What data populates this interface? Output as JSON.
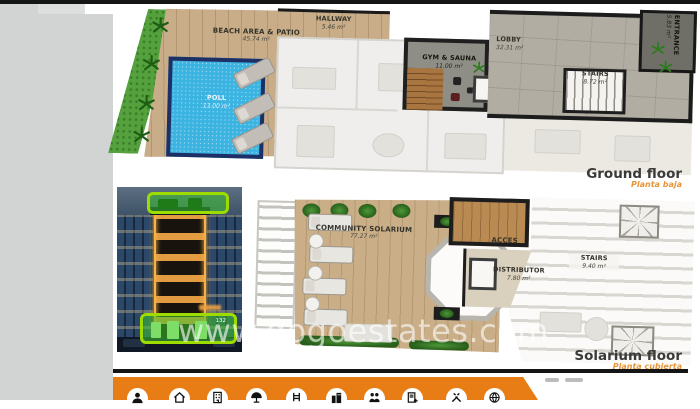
{
  "colors": {
    "accent_orange": "#e87d15",
    "subtitle_orange": "#e6953a",
    "highlight_green": "#9edc00",
    "pool_blue": "#3cb4e2",
    "title_gray": "#3a3a3a",
    "wall_black": "#1c1c1c"
  },
  "watermark": {
    "text": "www.gogoestates.com"
  },
  "photo": {
    "badge": "132"
  },
  "ground_floor": {
    "title": "Ground floor",
    "subtitle": "Planta baja",
    "rooms": {
      "beach": {
        "name": "BEACH AREA & PATIO",
        "area": "45.74 m²"
      },
      "pool": {
        "name": "POLL",
        "area": "13.00 m²"
      },
      "hallway": {
        "name": "HALLWAY",
        "area": "5.46 m²"
      },
      "gym": {
        "name": "GYM & SAUNA",
        "area": "11.00 m²"
      },
      "lobby": {
        "name": "LOBBY",
        "area": "32.31 m²"
      },
      "stairs": {
        "name": "STAIRS",
        "area": "8.72 m²"
      },
      "entrance": {
        "name": "ENTRANCE",
        "area": "5.83 m²"
      }
    }
  },
  "solarium_floor": {
    "title": "Solarium floor",
    "subtitle": "Planta cubierta",
    "rooms": {
      "community": {
        "name": "COMMUNITY SOLARIUM",
        "area": "77.27 m²"
      },
      "acces": {
        "name": "ACCES",
        "area": ""
      },
      "distributor": {
        "name": "DISTRIBUTOR",
        "area": "7.80 m²"
      },
      "stairs": {
        "name": "STAIRS",
        "area": "9.40 m²"
      }
    }
  },
  "toolbar": {
    "icons": [
      "person-icon",
      "house-icon",
      "apartment-icon",
      "beach-icon",
      "pool-ladder-icon",
      "city-icon",
      "family-icon",
      "document-icon",
      "tools-icon",
      "globe-icon"
    ]
  }
}
